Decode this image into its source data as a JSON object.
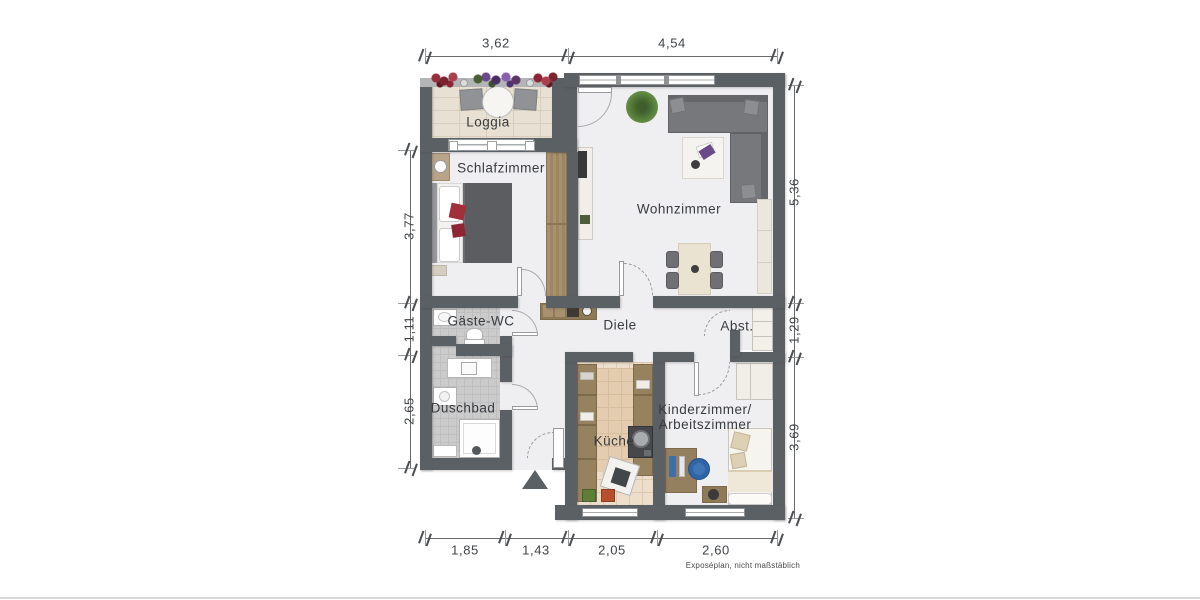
{
  "footnote": "Exposéplan, nicht maßstäblich",
  "rooms": {
    "loggia": {
      "label": "Loggia"
    },
    "schlafzimmer": {
      "label": "Schlafzimmer"
    },
    "wohnzimmer": {
      "label": "Wohnzimmer"
    },
    "gaeste_wc": {
      "label": "Gäste-WC"
    },
    "diele": {
      "label": "Diele"
    },
    "abstellraum": {
      "label": "Abst."
    },
    "duschbad": {
      "label": "Duschbad"
    },
    "kueche": {
      "label": "Küche"
    },
    "kinderzimmer": {
      "label_line1": "Kinderzimmer/",
      "label_line2": "Arbeitszimmer"
    }
  },
  "dimensions": {
    "top": [
      "3,62",
      "4,54"
    ],
    "left": [
      "3,77",
      "1,11",
      "2,65"
    ],
    "right": [
      "5,36",
      "1,29",
      "3,69"
    ],
    "bottom": [
      "1,85",
      "1,43",
      "2,05",
      "2,60"
    ]
  },
  "colors": {
    "wall": "#5b6065",
    "floor": "#efeef1",
    "loggia_tile": "#e8e0d2",
    "bath_tile": "#cbcbcb",
    "kitchen_tile": "#ecdecb",
    "wood": "#99835f",
    "sofa_gray": "#77787c",
    "bed_gray": "#5c5d61",
    "accent_red": "#a2303a",
    "accent_purple": "#6d4a8f",
    "chair_blue": "#2f64a6"
  }
}
